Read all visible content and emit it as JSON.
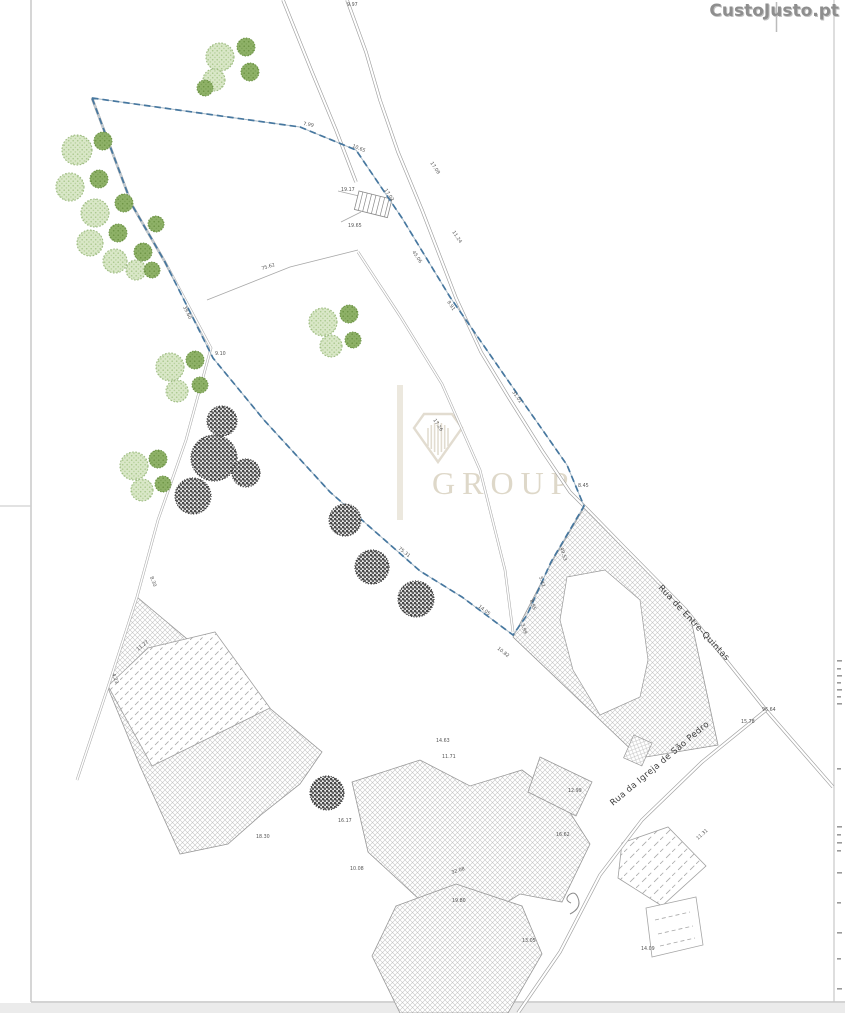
{
  "logo": {
    "text": "CustoJusto.pt",
    "color": "#8e8e8e"
  },
  "watermark": {
    "text": "GROUP",
    "color": "#d7cfbc",
    "icon": "diamond-gem-icon"
  },
  "streets": [
    {
      "name": "Rua de Entre-Quintas"
    },
    {
      "name": "Rua da Igreja de São Pedro"
    }
  ],
  "colors": {
    "boundary_blue": "#46779f",
    "tree_green_light": "#d9e6c8",
    "tree_green_dark": "#8fb269",
    "hatch_gray": "#c3c3c3",
    "line_gray": "#9f9f9f",
    "watermark_beige": "#d7cfbc",
    "page_border_gray": "#c8c8c8",
    "outside_strip": "#ebebeb"
  },
  "map": {
    "type": "cadastral-site-plan",
    "dimension_labels": [
      {
        "t": "9.97",
        "x": 347,
        "y": 6,
        "r": 0
      },
      {
        "t": "7.99",
        "x": 303,
        "y": 125,
        "r": 10
      },
      {
        "t": "10.65",
        "x": 352,
        "y": 147,
        "r": 22
      },
      {
        "t": "17.02",
        "x": 384,
        "y": 190,
        "r": 56
      },
      {
        "t": "19.17",
        "x": 341,
        "y": 191,
        "r": 0
      },
      {
        "t": "19.65",
        "x": 348,
        "y": 227,
        "r": 0
      },
      {
        "t": "45.06",
        "x": 412,
        "y": 252,
        "r": 56
      },
      {
        "t": "11.24",
        "x": 452,
        "y": 232,
        "r": 56
      },
      {
        "t": "8.91",
        "x": 447,
        "y": 302,
        "r": 56
      },
      {
        "t": "17.08",
        "x": 430,
        "y": 163,
        "r": 56
      },
      {
        "t": "31.01",
        "x": 512,
        "y": 392,
        "r": 56
      },
      {
        "t": "17.26",
        "x": 433,
        "y": 420,
        "r": 57
      },
      {
        "t": "49.53",
        "x": 560,
        "y": 548,
        "r": 72
      },
      {
        "t": "5.42",
        "x": 539,
        "y": 577,
        "r": 72
      },
      {
        "t": "8.95",
        "x": 530,
        "y": 600,
        "r": 72
      },
      {
        "t": "3.99",
        "x": 521,
        "y": 624,
        "r": 72
      },
      {
        "t": "10.82",
        "x": 497,
        "y": 649,
        "r": 38
      },
      {
        "t": "14.05",
        "x": 478,
        "y": 607,
        "r": 38
      },
      {
        "t": "75.31",
        "x": 398,
        "y": 549,
        "r": 38
      },
      {
        "t": "8.45",
        "x": 578,
        "y": 487,
        "r": 0
      },
      {
        "t": "39.60",
        "x": 183,
        "y": 307,
        "r": 64
      },
      {
        "t": "9.10",
        "x": 215,
        "y": 355,
        "r": 0
      },
      {
        "t": "75.62",
        "x": 262,
        "y": 270,
        "r": -17
      },
      {
        "t": "8.30",
        "x": 150,
        "y": 577,
        "r": 70
      },
      {
        "t": "4.23",
        "x": 112,
        "y": 674,
        "r": 70
      },
      {
        "t": "11.27",
        "x": 138,
        "y": 651,
        "r": -38
      },
      {
        "t": "18.30",
        "x": 256,
        "y": 838,
        "r": 0
      },
      {
        "t": "16.17",
        "x": 338,
        "y": 822,
        "r": 0
      },
      {
        "t": "10.08",
        "x": 350,
        "y": 870,
        "r": 0
      },
      {
        "t": "32.08",
        "x": 452,
        "y": 874,
        "r": -18
      },
      {
        "t": "14.63",
        "x": 436,
        "y": 742,
        "r": 0
      },
      {
        "t": "11.71",
        "x": 442,
        "y": 758,
        "r": 0
      },
      {
        "t": "19.80",
        "x": 452,
        "y": 902,
        "r": 0
      },
      {
        "t": "13.05",
        "x": 522,
        "y": 942,
        "r": 0
      },
      {
        "t": "16.62",
        "x": 556,
        "y": 836,
        "r": 0
      },
      {
        "t": "12.99",
        "x": 568,
        "y": 792,
        "r": 0
      },
      {
        "t": "96.64",
        "x": 762,
        "y": 711,
        "r": 0
      },
      {
        "t": "15.78",
        "x": 741,
        "y": 723,
        "r": 0
      },
      {
        "t": "14.09",
        "x": 641,
        "y": 950,
        "r": 0
      },
      {
        "t": "11.31",
        "x": 698,
        "y": 840,
        "r": -42
      }
    ],
    "trees": {
      "green_light": [
        {
          "x": 220,
          "y": 57,
          "r": 14
        },
        {
          "x": 214,
          "y": 80,
          "r": 11
        },
        {
          "x": 77,
          "y": 150,
          "r": 15
        },
        {
          "x": 70,
          "y": 187,
          "r": 14
        },
        {
          "x": 95,
          "y": 213,
          "r": 14
        },
        {
          "x": 90,
          "y": 243,
          "r": 13
        },
        {
          "x": 115,
          "y": 261,
          "r": 12
        },
        {
          "x": 136,
          "y": 270,
          "r": 10
        },
        {
          "x": 323,
          "y": 322,
          "r": 14
        },
        {
          "x": 331,
          "y": 346,
          "r": 11
        },
        {
          "x": 170,
          "y": 367,
          "r": 14
        },
        {
          "x": 177,
          "y": 391,
          "r": 11
        },
        {
          "x": 134,
          "y": 466,
          "r": 14
        },
        {
          "x": 142,
          "y": 490,
          "r": 11
        }
      ],
      "green_dark": [
        {
          "x": 246,
          "y": 47,
          "r": 9
        },
        {
          "x": 250,
          "y": 72,
          "r": 9
        },
        {
          "x": 205,
          "y": 88,
          "r": 8
        },
        {
          "x": 103,
          "y": 141,
          "r": 9
        },
        {
          "x": 99,
          "y": 179,
          "r": 9
        },
        {
          "x": 124,
          "y": 203,
          "r": 9
        },
        {
          "x": 118,
          "y": 233,
          "r": 9
        },
        {
          "x": 143,
          "y": 252,
          "r": 9
        },
        {
          "x": 156,
          "y": 224,
          "r": 8
        },
        {
          "x": 152,
          "y": 270,
          "r": 8
        },
        {
          "x": 349,
          "y": 314,
          "r": 9
        },
        {
          "x": 353,
          "y": 340,
          "r": 8
        },
        {
          "x": 195,
          "y": 360,
          "r": 9
        },
        {
          "x": 200,
          "y": 385,
          "r": 8
        },
        {
          "x": 158,
          "y": 459,
          "r": 9
        },
        {
          "x": 163,
          "y": 484,
          "r": 8
        }
      ],
      "dark": [
        {
          "x": 222,
          "y": 421,
          "r": 15
        },
        {
          "x": 214,
          "y": 458,
          "r": 23
        },
        {
          "x": 193,
          "y": 496,
          "r": 18
        },
        {
          "x": 246,
          "y": 473,
          "r": 14
        },
        {
          "x": 345,
          "y": 520,
          "r": 16
        },
        {
          "x": 372,
          "y": 567,
          "r": 17
        },
        {
          "x": 416,
          "y": 599,
          "r": 18
        },
        {
          "x": 327,
          "y": 793,
          "r": 17
        }
      ]
    }
  }
}
